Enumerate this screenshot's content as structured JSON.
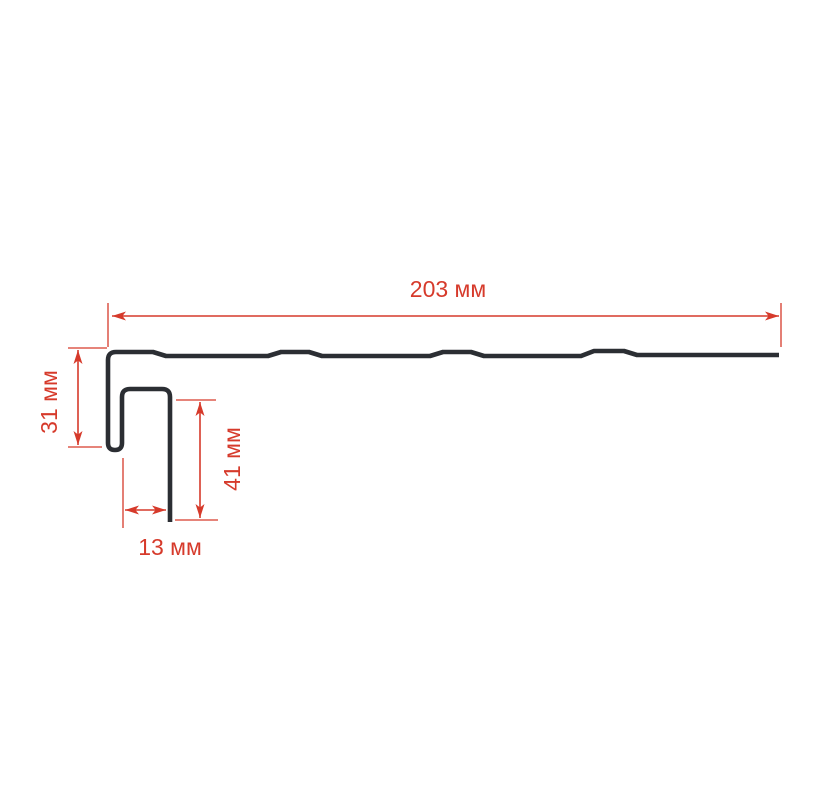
{
  "title": "Profile cross-section technical drawing",
  "colors": {
    "background": "#ffffff",
    "profile_line": "#2b2e33",
    "dimension_red": "#d63a2b"
  },
  "units": "мм",
  "dimensions": {
    "length": {
      "value": 203,
      "label": "203 мм"
    },
    "height": {
      "value": 31,
      "label": "31 мм"
    },
    "leg": {
      "value": 41,
      "label": "41 мм"
    },
    "width": {
      "value": 13,
      "label": "13 мм"
    }
  }
}
